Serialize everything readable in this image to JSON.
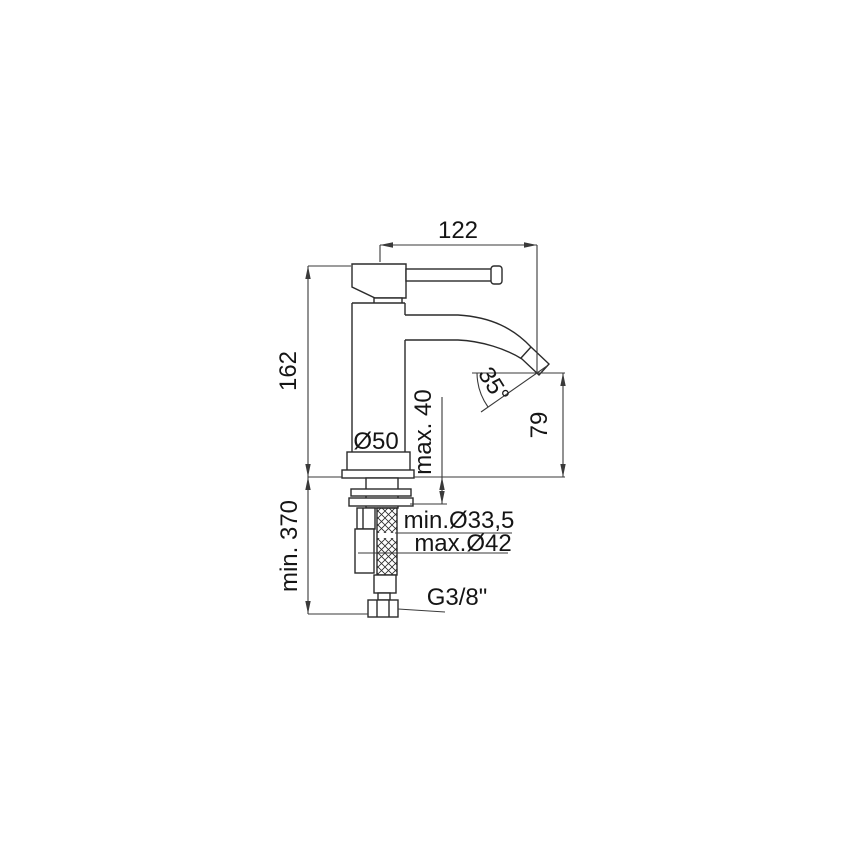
{
  "drawing": {
    "title": "basin-mixer-technical-drawing",
    "dimensions": {
      "spout_reach": "122",
      "body_height": "162",
      "hose_min_length": "min. 370",
      "base_diameter": "Ø50",
      "deck_max_thickness": "max. 40",
      "outlet_height": "79",
      "outlet_angle": "35°",
      "hole_min_diameter": "min.Ø33,5",
      "hole_max_diameter": "max.Ø42",
      "connection_thread": "G3/8\""
    },
    "colors": {
      "background": "#ffffff",
      "line": "#2b2b2b",
      "dimension_line": "#3a3a3a",
      "text": "#151515"
    }
  }
}
